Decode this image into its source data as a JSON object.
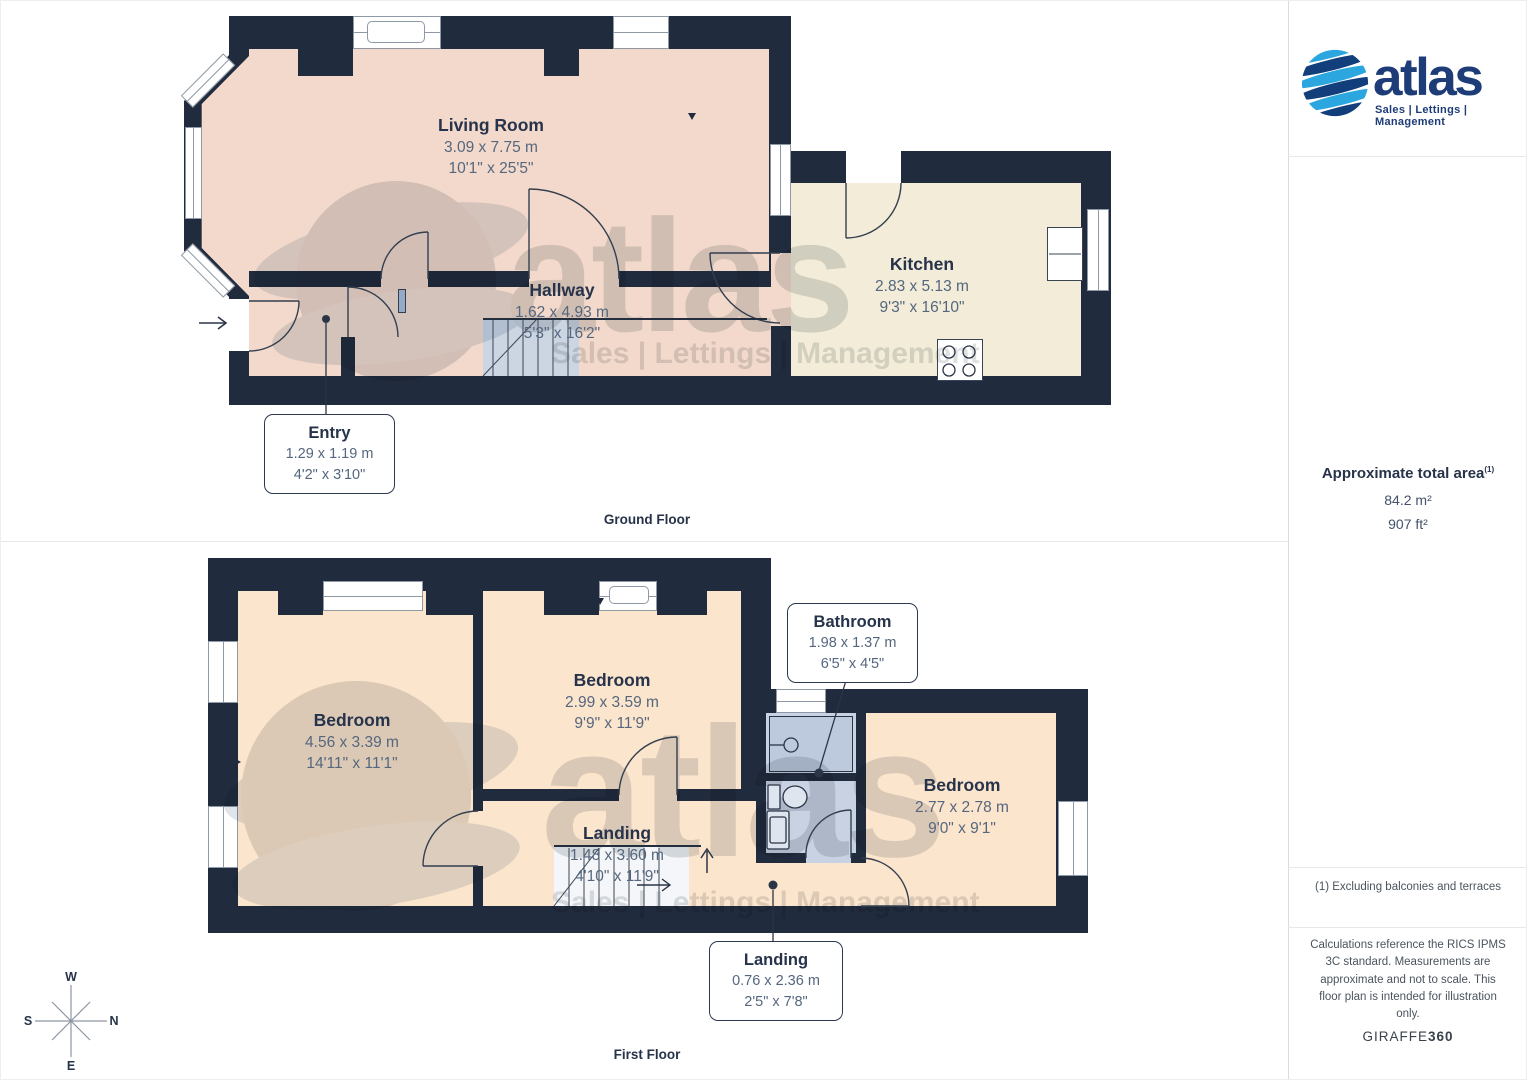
{
  "branding": {
    "name": "atlas",
    "tagline": "Sales | Lettings | Management"
  },
  "sidebar": {
    "area_heading": "Approximate total area",
    "area_marker": "(1)",
    "area_m2": "84.2 m²",
    "area_ft2": "907 ft²",
    "footnote": "(1) Excluding balconies and terraces",
    "disclaimer": "Calculations reference the RICS IPMS 3C standard. Measurements are approximate and not to scale. This floor plan is intended for illustration only.",
    "credit_name": "GIRAFFE",
    "credit_suffix": "360"
  },
  "floors": [
    {
      "label": "Ground Floor",
      "rooms": [
        {
          "name": "Living Room",
          "metric": "3.09 x 7.75 m",
          "imperial": "10'1\" x 25'5\""
        },
        {
          "name": "Hallway",
          "metric": "1.62 x 4.93 m",
          "imperial": "5'3\" x 16'2\""
        },
        {
          "name": "Kitchen",
          "metric": "2.83 x 5.13 m",
          "imperial": "9'3\" x 16'10\""
        }
      ],
      "callouts": [
        {
          "name": "Entry",
          "metric": "1.29 x 1.19 m",
          "imperial": "4'2\" x 3'10\""
        }
      ]
    },
    {
      "label": "First Floor",
      "rooms": [
        {
          "name": "Bedroom",
          "metric": "4.56 x 3.39 m",
          "imperial": "14'11\" x 11'1\""
        },
        {
          "name": "Bedroom",
          "metric": "2.99 x 3.59 m",
          "imperial": "9'9\" x 11'9\""
        },
        {
          "name": "Bedroom",
          "metric": "2.77 x 2.78 m",
          "imperial": "9'0\" x 9'1\""
        },
        {
          "name": "Landing",
          "metric": "1.48 x 3.60 m",
          "imperial": "4'10\" x 11'9\""
        }
      ],
      "callouts": [
        {
          "name": "Bathroom",
          "metric": "1.98 x 1.37 m",
          "imperial": "6'5\" x 4'5\""
        },
        {
          "name": "Landing",
          "metric": "0.76 x 2.36 m",
          "imperial": "2'5\" x 7'8\""
        }
      ]
    }
  ],
  "compass": {
    "top": "W",
    "left": "S",
    "right": "N",
    "bottom": "E"
  },
  "colors": {
    "wall": "#202b3d",
    "living_room_fill": "#f3d9cb",
    "kitchen_fill": "#f2ecd8",
    "bedroom_fill": "#fce5cd",
    "bathroom_fill": "#c9d2e2",
    "stairs_fill": "#ccd5e2",
    "logo_light_blue": "#2ca6de",
    "logo_dark_blue": "#123e7c",
    "text_navy": "#27334a",
    "dimension_text": "#55677e"
  }
}
